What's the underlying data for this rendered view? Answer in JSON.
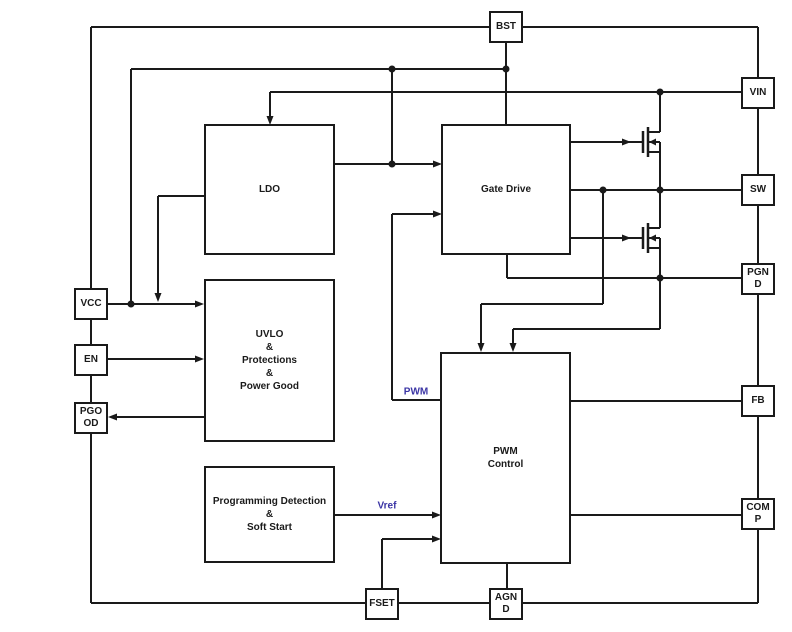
{
  "diagram": {
    "colors": {
      "line": "#1a1a1a",
      "signal_label": "#3b35a5",
      "background": "#ffffff"
    },
    "blocks": {
      "ldo": {
        "lines": [
          "LDO"
        ]
      },
      "gate_drive": {
        "lines": [
          "Gate Drive"
        ]
      },
      "uvlo": {
        "lines": [
          "UVLO",
          "&",
          "Protections",
          "&",
          "Power Good"
        ]
      },
      "pwm_control": {
        "lines": [
          "PWM",
          "Control"
        ]
      },
      "programming_detection": {
        "lines": [
          "Programming Detection",
          "&",
          "Soft Start"
        ]
      }
    },
    "pins": {
      "bst": {
        "lines": [
          "BST"
        ]
      },
      "vin": {
        "lines": [
          "VIN"
        ]
      },
      "sw": {
        "lines": [
          "SW"
        ]
      },
      "pgnd": {
        "lines": [
          "PGN",
          "D"
        ]
      },
      "fb": {
        "lines": [
          "FB"
        ]
      },
      "comp": {
        "lines": [
          "COM",
          "P"
        ]
      },
      "vcc": {
        "lines": [
          "VCC"
        ]
      },
      "en": {
        "lines": [
          "EN"
        ]
      },
      "pgood": {
        "lines": [
          "PGO",
          "OD"
        ]
      },
      "fset": {
        "lines": [
          "FSET"
        ]
      },
      "agnd": {
        "lines": [
          "AGN",
          "D"
        ]
      }
    },
    "signal_labels": {
      "pwm": "PWM",
      "vref": "Vref"
    }
  }
}
